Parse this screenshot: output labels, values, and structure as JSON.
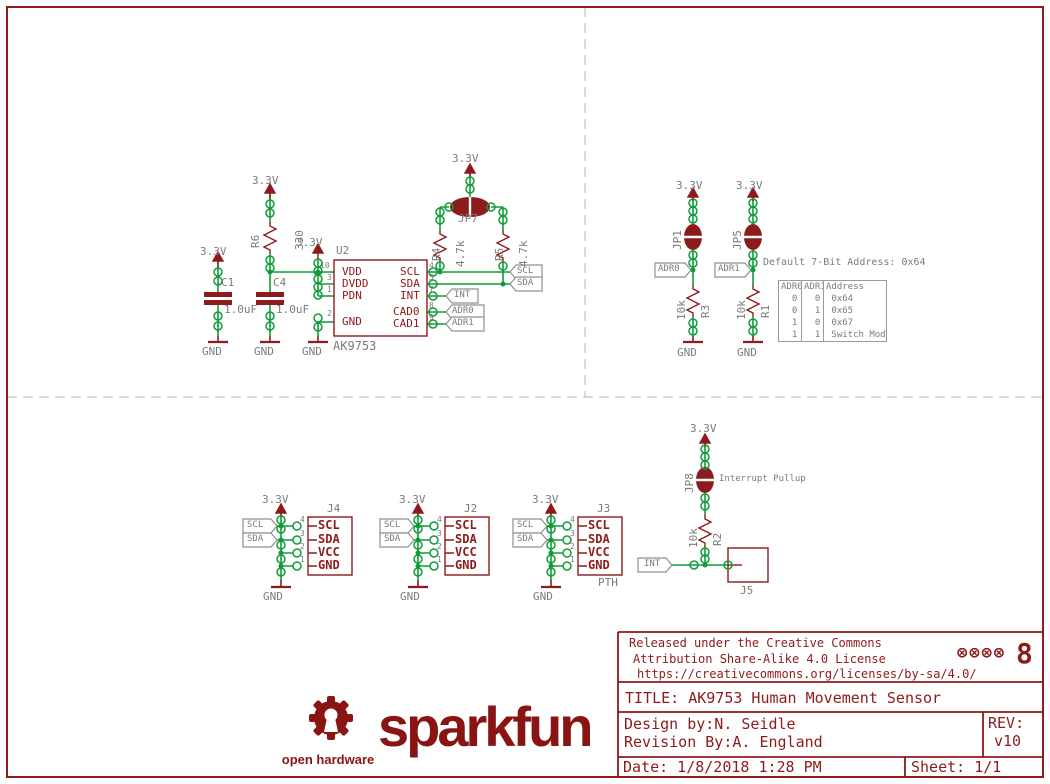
{
  "colors": {
    "schematic_red": "#8e1b1b",
    "wire_green": "#0e9c39",
    "label_gray": "#7b7b7b",
    "tag_gray": "#909090",
    "brand_red": "#8a1414",
    "dash_gray": "#b5b5b5"
  },
  "title_block": {
    "license_line1": "Released under the Creative Commons",
    "license_line2": "Attribution Share-Alike 4.0 License",
    "license_line3": "https://creativecommons.org/licenses/by-sa/4.0/",
    "cc_icons": "⊗⊗⊗⊗",
    "oshw_mark": "8",
    "title": "TITLE: AK9753 Human Movement Sensor",
    "design_by": "Design by:N. Seidle",
    "revision_by": "Revision By:A. England",
    "rev_label": "REV:",
    "rev_value": "v10",
    "date": "Date: 1/8/2018 1:28 PM",
    "sheet": "Sheet: 1/1"
  },
  "logo": {
    "brand": "sparkfun",
    "sub": "open hardware"
  },
  "address_table": {
    "note": "Default 7-Bit Address: 0x64",
    "headers": [
      "ADR0",
      "ADR1",
      "Address"
    ],
    "rows": [
      [
        "0",
        "0",
        "0x64"
      ],
      [
        "0",
        "1",
        "0x65"
      ],
      [
        "1",
        "0",
        "0x67"
      ],
      [
        "1",
        "1",
        "Switch Mode"
      ]
    ]
  },
  "labels": [
    {
      "t": "3.3V",
      "x": 200,
      "y": 246,
      "c": "",
      "n": "power-net-label"
    },
    {
      "t": "C1",
      "x": 221,
      "y": 277,
      "c": "",
      "n": "refdes"
    },
    {
      "t": "1.0uF",
      "x": 224,
      "y": 304,
      "c": "",
      "n": "value-label"
    },
    {
      "t": "GND",
      "x": 202,
      "y": 346,
      "c": "",
      "n": "gnd-label"
    },
    {
      "t": "3.3V",
      "x": 252,
      "y": 175,
      "c": "",
      "n": "power-net-label"
    },
    {
      "t": "R6",
      "x": 250,
      "y": 248,
      "c": "rot",
      "n": "refdes"
    },
    {
      "t": "330",
      "x": 294,
      "y": 250,
      "c": "rot",
      "n": "value-label"
    },
    {
      "t": "C4",
      "x": 273,
      "y": 277,
      "c": "",
      "n": "refdes"
    },
    {
      "t": "1.0uF",
      "x": 276,
      "y": 304,
      "c": "",
      "n": "value-label"
    },
    {
      "t": "GND",
      "x": 254,
      "y": 346,
      "c": "",
      "n": "gnd-label"
    },
    {
      "t": "3.3V",
      "x": 296,
      "y": 237,
      "c": "",
      "n": "power-net-label"
    },
    {
      "t": "GND",
      "x": 302,
      "y": 346,
      "c": "",
      "n": "gnd-label"
    },
    {
      "t": "U2",
      "x": 336,
      "y": 245,
      "c": "",
      "n": "refdes"
    },
    {
      "t": "AK9753",
      "x": 333,
      "y": 340,
      "c": "g12",
      "n": "part-number"
    },
    {
      "t": "VDD",
      "x": 342,
      "y": 266,
      "c": "r",
      "n": "pin-name"
    },
    {
      "t": "DVDD",
      "x": 342,
      "y": 278,
      "c": "r",
      "n": "pin-name"
    },
    {
      "t": "PDN",
      "x": 342,
      "y": 290,
      "c": "r",
      "n": "pin-name"
    },
    {
      "t": "GND",
      "x": 342,
      "y": 316,
      "c": "r",
      "n": "pin-name"
    },
    {
      "t": "SCL",
      "x": 400,
      "y": 266,
      "c": "r",
      "n": "pin-name"
    },
    {
      "t": "SDA",
      "x": 400,
      "y": 278,
      "c": "r",
      "n": "pin-name"
    },
    {
      "t": "INT",
      "x": 400,
      "y": 290,
      "c": "r",
      "n": "pin-name"
    },
    {
      "t": "CAD0",
      "x": 393,
      "y": 306,
      "c": "r",
      "n": "pin-name"
    },
    {
      "t": "CAD1",
      "x": 393,
      "y": 318,
      "c": "r",
      "n": "pin-name"
    },
    {
      "t": "10",
      "x": 320,
      "y": 262,
      "c": "g8",
      "n": "pin-number"
    },
    {
      "t": "3",
      "x": 327,
      "y": 274,
      "c": "g8",
      "n": "pin-number"
    },
    {
      "t": "1",
      "x": 327,
      "y": 286,
      "c": "g8",
      "n": "pin-number"
    },
    {
      "t": "2",
      "x": 327,
      "y": 310,
      "c": "g8",
      "n": "pin-number"
    },
    {
      "t": "4",
      "x": 429,
      "y": 262,
      "c": "g8",
      "n": "pin-number"
    },
    {
      "t": "5",
      "x": 429,
      "y": 274,
      "c": "g8",
      "n": "pin-number"
    },
    {
      "t": "7",
      "x": 429,
      "y": 286,
      "c": "g8",
      "n": "pin-number"
    },
    {
      "t": "8",
      "x": 429,
      "y": 302,
      "c": "g8",
      "n": "pin-number"
    },
    {
      "t": "9",
      "x": 429,
      "y": 314,
      "c": "g8",
      "n": "pin-number"
    },
    {
      "t": "3.3V",
      "x": 452,
      "y": 153,
      "c": "",
      "n": "power-net-label"
    },
    {
      "t": "JP7",
      "x": 458,
      "y": 213,
      "c": "",
      "n": "refdes"
    },
    {
      "t": "R4",
      "x": 431,
      "y": 261,
      "c": "rot",
      "n": "refdes"
    },
    {
      "t": "4.7k",
      "x": 455,
      "y": 267,
      "c": "rot",
      "n": "value-label"
    },
    {
      "t": "R5",
      "x": 494,
      "y": 261,
      "c": "rot",
      "n": "refdes"
    },
    {
      "t": "4.7k",
      "x": 518,
      "y": 267,
      "c": "rot",
      "n": "value-label"
    },
    {
      "t": "SCL",
      "x": 517,
      "y": 267,
      "c": "g9",
      "n": "net-flag-label"
    },
    {
      "t": "SDA",
      "x": 517,
      "y": 279,
      "c": "g9",
      "n": "net-flag-label"
    },
    {
      "t": "INT",
      "x": 454,
      "y": 291,
      "c": "g9",
      "n": "net-flag-label"
    },
    {
      "t": "ADR0",
      "x": 452,
      "y": 307,
      "c": "g9",
      "n": "net-flag-label"
    },
    {
      "t": "ADR1",
      "x": 452,
      "y": 319,
      "c": "g9",
      "n": "net-flag-label"
    },
    {
      "t": "3.3V",
      "x": 676,
      "y": 180,
      "c": "",
      "n": "power-net-label"
    },
    {
      "t": "3.3V",
      "x": 736,
      "y": 180,
      "c": "",
      "n": "power-net-label"
    },
    {
      "t": "JP1",
      "x": 672,
      "y": 250,
      "c": "rot",
      "n": "refdes"
    },
    {
      "t": "JP5",
      "x": 732,
      "y": 250,
      "c": "rot",
      "n": "refdes"
    },
    {
      "t": "ADR0",
      "x": 658,
      "y": 265,
      "c": "g9",
      "n": "net-flag-label"
    },
    {
      "t": "ADR1",
      "x": 718,
      "y": 265,
      "c": "g9",
      "n": "net-flag-label"
    },
    {
      "t": "10k",
      "x": 676,
      "y": 320,
      "c": "rot",
      "n": "value-label"
    },
    {
      "t": "R3",
      "x": 700,
      "y": 318,
      "c": "rot",
      "n": "refdes"
    },
    {
      "t": "10k",
      "x": 736,
      "y": 320,
      "c": "rot",
      "n": "value-label"
    },
    {
      "t": "R1",
      "x": 760,
      "y": 318,
      "c": "rot",
      "n": "refdes"
    },
    {
      "t": "GND",
      "x": 677,
      "y": 347,
      "c": "",
      "n": "gnd-label"
    },
    {
      "t": "GND",
      "x": 737,
      "y": 347,
      "c": "",
      "n": "gnd-label"
    },
    {
      "t": "Default 7-Bit Address: 0x64",
      "x": 763,
      "y": 258,
      "c": "g10",
      "n": "table-note"
    },
    {
      "t": "3.3V",
      "x": 262,
      "y": 494,
      "c": "",
      "n": "power-net-label"
    },
    {
      "t": "J4",
      "x": 327,
      "y": 503,
      "c": "",
      "n": "refdes"
    },
    {
      "t": "GND",
      "x": 263,
      "y": 591,
      "c": "",
      "n": "gnd-label"
    },
    {
      "t": "SCL",
      "x": 247,
      "y": 521,
      "c": "g9",
      "n": "net-flag-label"
    },
    {
      "t": "SDA",
      "x": 247,
      "y": 535,
      "c": "g9",
      "n": "net-flag-label"
    },
    {
      "t": "SCL",
      "x": 318,
      "y": 519,
      "c": "rb",
      "n": "connector-pin-label"
    },
    {
      "t": "SDA",
      "x": 318,
      "y": 533,
      "c": "rb",
      "n": "connector-pin-label"
    },
    {
      "t": "VCC",
      "x": 318,
      "y": 546,
      "c": "rb",
      "n": "connector-pin-label"
    },
    {
      "t": "GND",
      "x": 318,
      "y": 559,
      "c": "rb",
      "n": "connector-pin-label"
    },
    {
      "t": "4",
      "x": 300,
      "y": 516,
      "c": "g8",
      "n": "pin-number"
    },
    {
      "t": "3",
      "x": 300,
      "y": 530,
      "c": "g8",
      "n": "pin-number"
    },
    {
      "t": "2",
      "x": 300,
      "y": 543,
      "c": "g8",
      "n": "pin-number"
    },
    {
      "t": "1",
      "x": 300,
      "y": 556,
      "c": "g8",
      "n": "pin-number"
    },
    {
      "t": "3.3V",
      "x": 399,
      "y": 494,
      "c": "",
      "n": "power-net-label"
    },
    {
      "t": "J2",
      "x": 464,
      "y": 503,
      "c": "",
      "n": "refdes"
    },
    {
      "t": "GND",
      "x": 400,
      "y": 591,
      "c": "",
      "n": "gnd-label"
    },
    {
      "t": "SCL",
      "x": 384,
      "y": 521,
      "c": "g9",
      "n": "net-flag-label"
    },
    {
      "t": "SDA",
      "x": 384,
      "y": 535,
      "c": "g9",
      "n": "net-flag-label"
    },
    {
      "t": "SCL",
      "x": 455,
      "y": 519,
      "c": "rb",
      "n": "connector-pin-label"
    },
    {
      "t": "SDA",
      "x": 455,
      "y": 533,
      "c": "rb",
      "n": "connector-pin-label"
    },
    {
      "t": "VCC",
      "x": 455,
      "y": 546,
      "c": "rb",
      "n": "connector-pin-label"
    },
    {
      "t": "GND",
      "x": 455,
      "y": 559,
      "c": "rb",
      "n": "connector-pin-label"
    },
    {
      "t": "4",
      "x": 437,
      "y": 516,
      "c": "g8",
      "n": "pin-number"
    },
    {
      "t": "3",
      "x": 437,
      "y": 530,
      "c": "g8",
      "n": "pin-number"
    },
    {
      "t": "2",
      "x": 437,
      "y": 543,
      "c": "g8",
      "n": "pin-number"
    },
    {
      "t": "1",
      "x": 437,
      "y": 556,
      "c": "g8",
      "n": "pin-number"
    },
    {
      "t": "3.3V",
      "x": 532,
      "y": 494,
      "c": "",
      "n": "power-net-label"
    },
    {
      "t": "J3",
      "x": 597,
      "y": 503,
      "c": "",
      "n": "refdes"
    },
    {
      "t": "GND",
      "x": 533,
      "y": 591,
      "c": "",
      "n": "gnd-label"
    },
    {
      "t": "SCL",
      "x": 517,
      "y": 521,
      "c": "g9",
      "n": "net-flag-label"
    },
    {
      "t": "SDA",
      "x": 517,
      "y": 535,
      "c": "g9",
      "n": "net-flag-label"
    },
    {
      "t": "SCL",
      "x": 588,
      "y": 519,
      "c": "rb",
      "n": "connector-pin-label"
    },
    {
      "t": "SDA",
      "x": 588,
      "y": 533,
      "c": "rb",
      "n": "connector-pin-label"
    },
    {
      "t": "VCC",
      "x": 588,
      "y": 546,
      "c": "rb",
      "n": "connector-pin-label"
    },
    {
      "t": "GND",
      "x": 588,
      "y": 559,
      "c": "rb",
      "n": "connector-pin-label"
    },
    {
      "t": "4",
      "x": 570,
      "y": 516,
      "c": "g8",
      "n": "pin-number"
    },
    {
      "t": "3",
      "x": 570,
      "y": 530,
      "c": "g8",
      "n": "pin-number"
    },
    {
      "t": "2",
      "x": 570,
      "y": 543,
      "c": "g8",
      "n": "pin-number"
    },
    {
      "t": "1",
      "x": 570,
      "y": 556,
      "c": "g8",
      "n": "pin-number"
    },
    {
      "t": "PTH",
      "x": 598,
      "y": 577,
      "c": "",
      "n": "mount-type-label"
    },
    {
      "t": "3.3V",
      "x": 690,
      "y": 423,
      "c": "",
      "n": "power-net-label"
    },
    {
      "t": "JP8",
      "x": 684,
      "y": 493,
      "c": "rot",
      "n": "refdes"
    },
    {
      "t": "Interrupt Pullup",
      "x": 719,
      "y": 475,
      "c": "g9",
      "n": "jumper-note"
    },
    {
      "t": "10k",
      "x": 688,
      "y": 548,
      "c": "rot",
      "n": "value-label"
    },
    {
      "t": "R2",
      "x": 712,
      "y": 546,
      "c": "rot",
      "n": "refdes"
    },
    {
      "t": "INT",
      "x": 644,
      "y": 560,
      "c": "g9",
      "n": "net-flag-label"
    },
    {
      "t": "J5",
      "x": 740,
      "y": 585,
      "c": "",
      "n": "refdes"
    }
  ]
}
